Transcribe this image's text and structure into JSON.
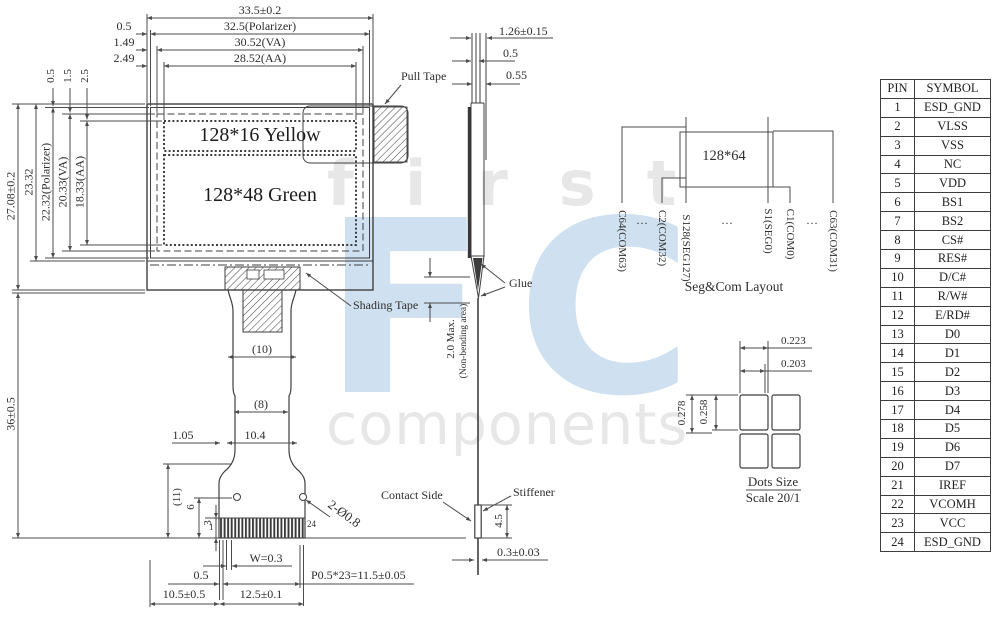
{
  "watermark": {
    "word_top": "first",
    "word_logo": "FC",
    "word_bottom": "components",
    "logo_color": "#cfe1f1",
    "text_color": "#e7e7e7"
  },
  "front_view": {
    "display_yellow": "128*16 Yellow",
    "display_green": "128*48 Green",
    "labels": {
      "pull_tape": "Pull Tape",
      "shading_tape": "Shading Tape"
    },
    "dims": {
      "width_total": "33.5±0.2",
      "width_polarizer": "32.5(Polarizer)",
      "width_va": "30.52(VA)",
      "width_aa": "28.52(AA)",
      "offset_polarizer": "0.5",
      "offset_va": "1.49",
      "offset_aa": "2.49",
      "height_total": "27.08±0.2",
      "height_glass": "23.32",
      "height_polarizer": "22.32(Polarizer)",
      "height_va": "20.33(VA)",
      "height_aa": "18.33(AA)",
      "voffset_polarizer": "0.5",
      "voffset_va": "1.5",
      "voffset_aa": "2.5",
      "module_height": "36±0.5",
      "fpc_width_10": "(10)",
      "fpc_width_8": "(8)",
      "fpc_1_05": "1.05",
      "fpc_10_4": "10.4",
      "fpc_11": "(11)",
      "fpc_6": "6",
      "fpc_3": "3",
      "pin_first": "1",
      "pin_last": "24",
      "holes": "2-Ø0.8",
      "pad_width": "W=0.3",
      "pad_offset": "0.5",
      "fpc_10_5": "10.5±0.5",
      "fpc_12_5": "12.5±0.1",
      "pitch": "P0.5*23=11.5±0.05"
    }
  },
  "side_view": {
    "dims": {
      "thickness": "1.26±0.15",
      "t_0_5": "0.5",
      "t_0_55": "0.55",
      "bend": "2.0 Max.",
      "bend_note": "(Non-bending area)",
      "stiffener_h": "4.5",
      "fpc_t": "0.3±0.03"
    },
    "labels": {
      "glue": "Glue",
      "contact": "Contact Side",
      "stiffener": "Stiffener"
    }
  },
  "segcom": {
    "matrix": "128*64",
    "caption": "Seg&Com Layout",
    "dots": "···",
    "pins": [
      "C64(COM63)",
      "C2(COM32)",
      "S128(SEG127)",
      "S1(SEG0)",
      "C1(COM0)",
      "C63(COM31)"
    ]
  },
  "dot_size": {
    "w_pitch": "0.223",
    "w_dot": "0.203",
    "h_pitch": "0.278",
    "h_dot": "0.258",
    "caption_line1": "Dots Size",
    "caption_line2": "Scale 20/1"
  },
  "pin_table": {
    "headers": [
      "PIN",
      "SYMBOL"
    ],
    "rows": [
      [
        "1",
        "ESD_GND"
      ],
      [
        "2",
        "VLSS"
      ],
      [
        "3",
        "VSS"
      ],
      [
        "4",
        "NC"
      ],
      [
        "5",
        "VDD"
      ],
      [
        "6",
        "BS1"
      ],
      [
        "7",
        "BS2"
      ],
      [
        "8",
        "CS#"
      ],
      [
        "9",
        "RES#"
      ],
      [
        "10",
        "D/C#"
      ],
      [
        "11",
        "R/W#"
      ],
      [
        "12",
        "E/RD#"
      ],
      [
        "13",
        "D0"
      ],
      [
        "14",
        "D1"
      ],
      [
        "15",
        "D2"
      ],
      [
        "16",
        "D3"
      ],
      [
        "17",
        "D4"
      ],
      [
        "18",
        "D5"
      ],
      [
        "19",
        "D6"
      ],
      [
        "20",
        "D7"
      ],
      [
        "21",
        "IREF"
      ],
      [
        "22",
        "VCOMH"
      ],
      [
        "23",
        "VCC"
      ],
      [
        "24",
        "ESD_GND"
      ]
    ]
  }
}
